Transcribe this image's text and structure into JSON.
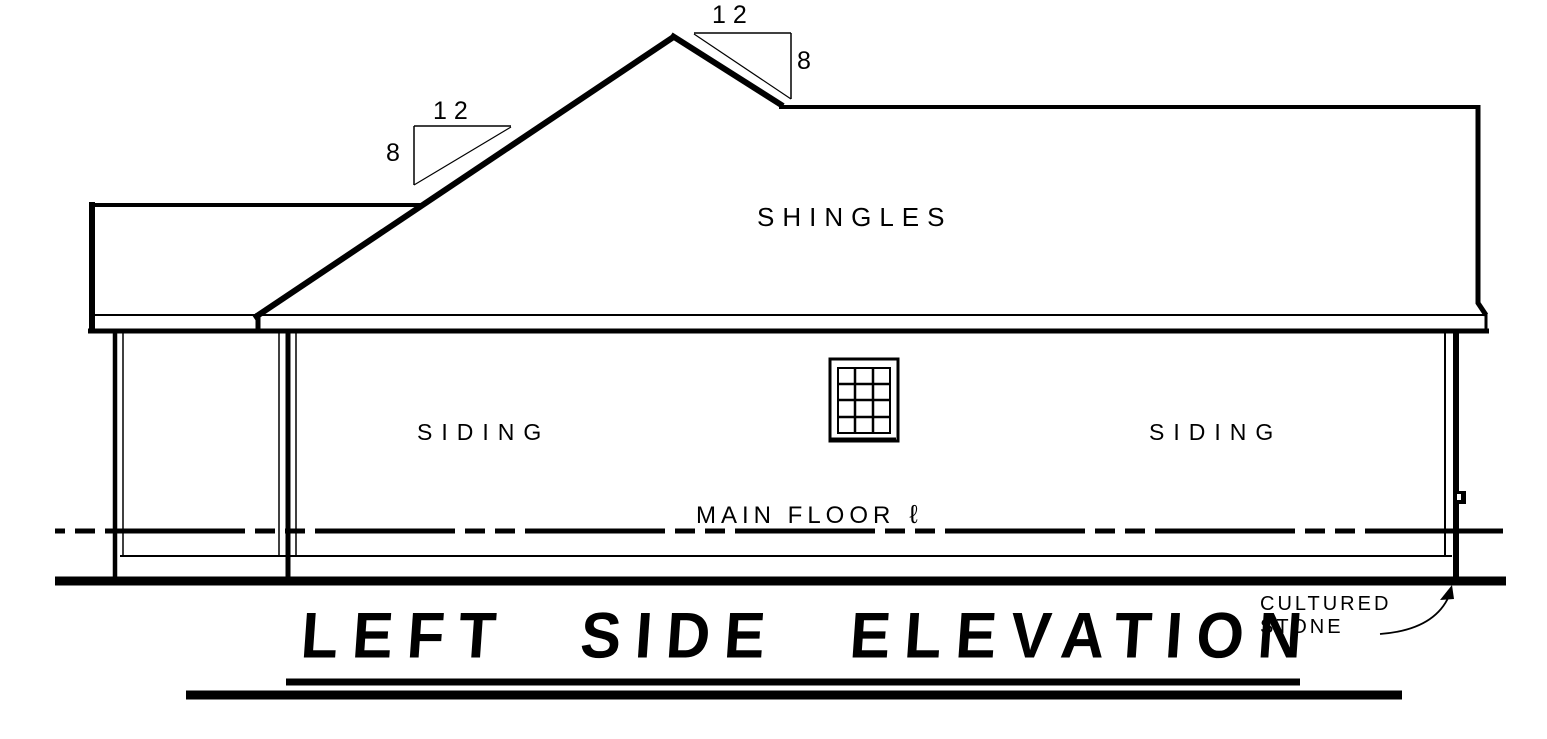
{
  "drawing": {
    "title": "LEFT SIDE ELEVATION",
    "roof_label": "SHINGLES",
    "wall_labels": {
      "left": "SIDING",
      "right": "SIDING"
    },
    "floor_line": {
      "label": "MAIN FLOOR",
      "symbol": "ℓ"
    },
    "foundation_note": {
      "line1": "CULTURED",
      "line2": "STONE"
    },
    "pitch_left": {
      "run": "12",
      "rise": "8"
    },
    "pitch_right": {
      "run": "12",
      "rise": "8"
    },
    "colors": {
      "ink": "#000000",
      "paper": "#ffffff"
    }
  }
}
